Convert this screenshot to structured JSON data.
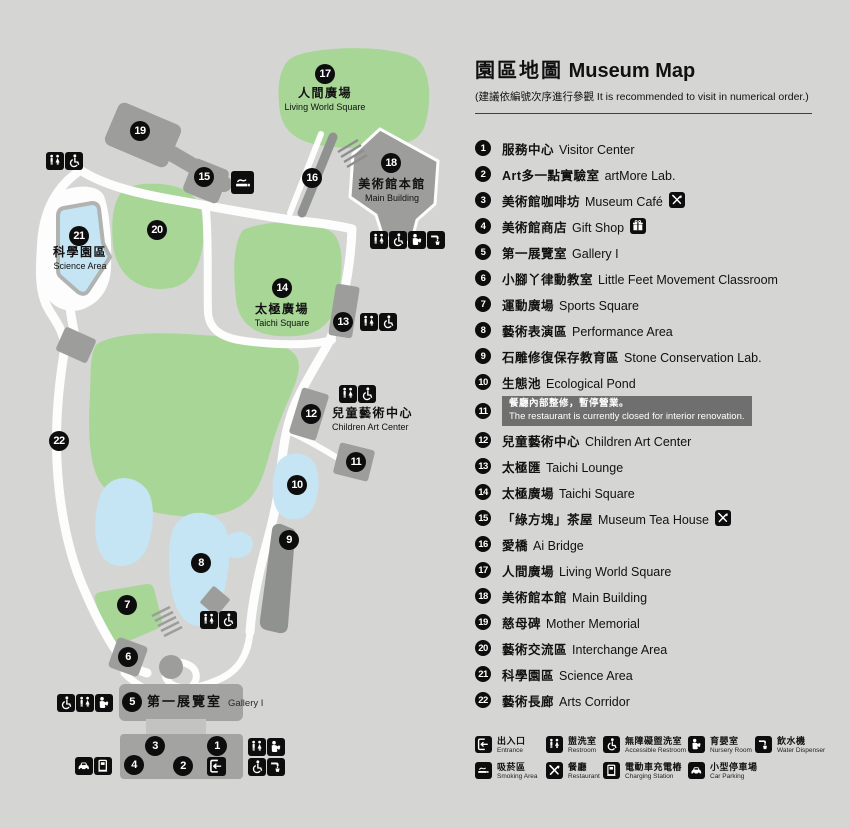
{
  "panel": {
    "title_zh": "園區地圖",
    "title_en": "Museum Map",
    "subtitle": "(建議依編號次序進行參觀 It is recommended to visit in numerical order.)"
  },
  "poi_list": [
    {
      "num": 1,
      "zh": "服務中心",
      "en": "Visitor Center"
    },
    {
      "num": 2,
      "zh": "Art多一點實驗室",
      "en": "artMore Lab."
    },
    {
      "num": 3,
      "zh": "美術館咖啡坊",
      "en": "Museum Café",
      "icon": "restaurant"
    },
    {
      "num": 4,
      "zh": "美術館商店",
      "en": "Gift Shop",
      "icon": "gift"
    },
    {
      "num": 5,
      "zh": "第一展覽室",
      "en": "Gallery I"
    },
    {
      "num": 6,
      "zh": "小腳丫律動教室",
      "en": "Little Feet Movement Classroom"
    },
    {
      "num": 7,
      "zh": "運動廣場",
      "en": "Sports Square"
    },
    {
      "num": 8,
      "zh": "藝術表演區",
      "en": "Performance Area"
    },
    {
      "num": 9,
      "zh": "石雕修復保存教育區",
      "en": "Stone Conservation Lab."
    },
    {
      "num": 10,
      "zh": "生態池",
      "en": "Ecological Pond"
    },
    {
      "num": 11,
      "notice": {
        "zh": "餐廳內部整修，暫停營業。",
        "en": "The restaurant is currently closed for interior renovation."
      }
    },
    {
      "num": 12,
      "zh": "兒童藝術中心",
      "en": "Children Art Center"
    },
    {
      "num": 13,
      "zh": "太極匯",
      "en": "Taichi Lounge"
    },
    {
      "num": 14,
      "zh": "太極廣場",
      "en": "Taichi Square"
    },
    {
      "num": 15,
      "zh": "「綠方塊」茶屋",
      "en": "Museum Tea House",
      "icon": "restaurant"
    },
    {
      "num": 16,
      "zh": "愛橋",
      "en": "Ai Bridge"
    },
    {
      "num": 17,
      "zh": "人間廣場",
      "en": "Living World Square"
    },
    {
      "num": 18,
      "zh": "美術館本館",
      "en": "Main Building"
    },
    {
      "num": 19,
      "zh": "慈母碑",
      "en": "Mother Memorial"
    },
    {
      "num": 20,
      "zh": "藝術交流區",
      "en": "Interchange Area"
    },
    {
      "num": 21,
      "zh": "科學園區",
      "en": "Science Area"
    },
    {
      "num": 22,
      "zh": "藝術長廊",
      "en": "Arts Corridor"
    }
  ],
  "facilities": [
    {
      "icon": "entrance",
      "zh": "出入口",
      "en": "Entrance"
    },
    {
      "icon": "restroom",
      "zh": "盥洗室",
      "en": "Restroom"
    },
    {
      "icon": "accessible",
      "zh": "無障礙盥洗室",
      "en": "Accessible Restroom"
    },
    {
      "icon": "nursery",
      "zh": "育嬰室",
      "en": "Nursery Room"
    },
    {
      "icon": "water",
      "zh": "飲水機",
      "en": "Water Dispenser"
    },
    {
      "icon": "smoking",
      "zh": "吸菸區",
      "en": "Smoking Area"
    },
    {
      "icon": "restaurant",
      "zh": "餐廳",
      "en": "Restaurant"
    },
    {
      "icon": "charging",
      "zh": "電動車充電樁",
      "en": "Charging Station"
    },
    {
      "icon": "parking",
      "zh": "小型停車場",
      "en": "Car Parking"
    }
  ],
  "map": {
    "colors": {
      "background": "#d5d6d4",
      "green": "#a8d696",
      "pond": "#c5e5f4",
      "pond_border": "#b0b3b0",
      "building": "#9d9e9c",
      "path": "#fdfdfd",
      "marker": "#0d0d0d",
      "notice_bg": "#6f6f6f"
    },
    "markers": [
      {
        "n": 1,
        "x": 217,
        "y": 746
      },
      {
        "n": 2,
        "x": 183,
        "y": 766
      },
      {
        "n": 3,
        "x": 155,
        "y": 746
      },
      {
        "n": 4,
        "x": 134,
        "y": 765
      },
      {
        "n": 5,
        "x": 132,
        "y": 702
      },
      {
        "n": 6,
        "x": 128,
        "y": 657
      },
      {
        "n": 7,
        "x": 127,
        "y": 605
      },
      {
        "n": 8,
        "x": 201,
        "y": 563
      },
      {
        "n": 9,
        "x": 289,
        "y": 540
      },
      {
        "n": 10,
        "x": 297,
        "y": 485
      },
      {
        "n": 11,
        "x": 356,
        "y": 462
      },
      {
        "n": 12,
        "x": 311,
        "y": 414
      },
      {
        "n": 13,
        "x": 343,
        "y": 322
      },
      {
        "n": 14,
        "x": 282,
        "y": 288
      },
      {
        "n": 15,
        "x": 204,
        "y": 177
      },
      {
        "n": 16,
        "x": 312,
        "y": 178
      },
      {
        "n": 17,
        "x": 325,
        "y": 74
      },
      {
        "n": 18,
        "x": 391,
        "y": 163
      },
      {
        "n": 19,
        "x": 140,
        "y": 131
      },
      {
        "n": 20,
        "x": 157,
        "y": 230
      },
      {
        "n": 21,
        "x": 79,
        "y": 236
      },
      {
        "n": 22,
        "x": 59,
        "y": 441
      }
    ],
    "labels": [
      {
        "zh": "人間廣場",
        "en": "Living World Square",
        "x": 325,
        "y": 86,
        "style": "center"
      },
      {
        "zh": "美術館本館",
        "en": "Main Building",
        "x": 392,
        "y": 177,
        "style": "center"
      },
      {
        "zh": "科學園區",
        "en": "Science Area",
        "x": 80,
        "y": 245,
        "style": "center"
      },
      {
        "zh": "太極廣場",
        "en": "Taichi Square",
        "x": 282,
        "y": 302,
        "style": "center"
      },
      {
        "zh": "兒童藝術中心",
        "en": "Children Art Center",
        "x": 332,
        "y": 406,
        "style": "left"
      },
      {
        "zh": "第一展覽室",
        "en": "Gallery I",
        "x": 147,
        "y": 694,
        "style": "inline"
      }
    ],
    "icon_groups": [
      {
        "x": 46,
        "y": 152,
        "icons": [
          "restroom",
          "accessible"
        ]
      },
      {
        "x": 231,
        "y": 171,
        "icons": [
          "smoking"
        ],
        "size": 23
      },
      {
        "x": 370,
        "y": 231,
        "icons": [
          "restroom",
          "accessible",
          "nursery",
          "water"
        ]
      },
      {
        "x": 360,
        "y": 313,
        "icons": [
          "restroom",
          "accessible"
        ]
      },
      {
        "x": 339,
        "y": 385,
        "icons": [
          "restroom",
          "accessible"
        ]
      },
      {
        "x": 200,
        "y": 611,
        "icons": [
          "restroom",
          "accessible"
        ]
      },
      {
        "x": 57,
        "y": 694,
        "icons": [
          "accessible",
          "restroom",
          "nursery"
        ]
      },
      {
        "x": 75,
        "y": 757,
        "icons": [
          "parking",
          "charging"
        ]
      },
      {
        "x": 248,
        "y": 738,
        "icons": [
          "restroom",
          "nursery"
        ]
      },
      {
        "x": 248,
        "y": 758,
        "icons": [
          "accessible",
          "water"
        ]
      },
      {
        "x": 207,
        "y": 757,
        "icons": [
          "entrance"
        ],
        "size": 19
      }
    ]
  }
}
